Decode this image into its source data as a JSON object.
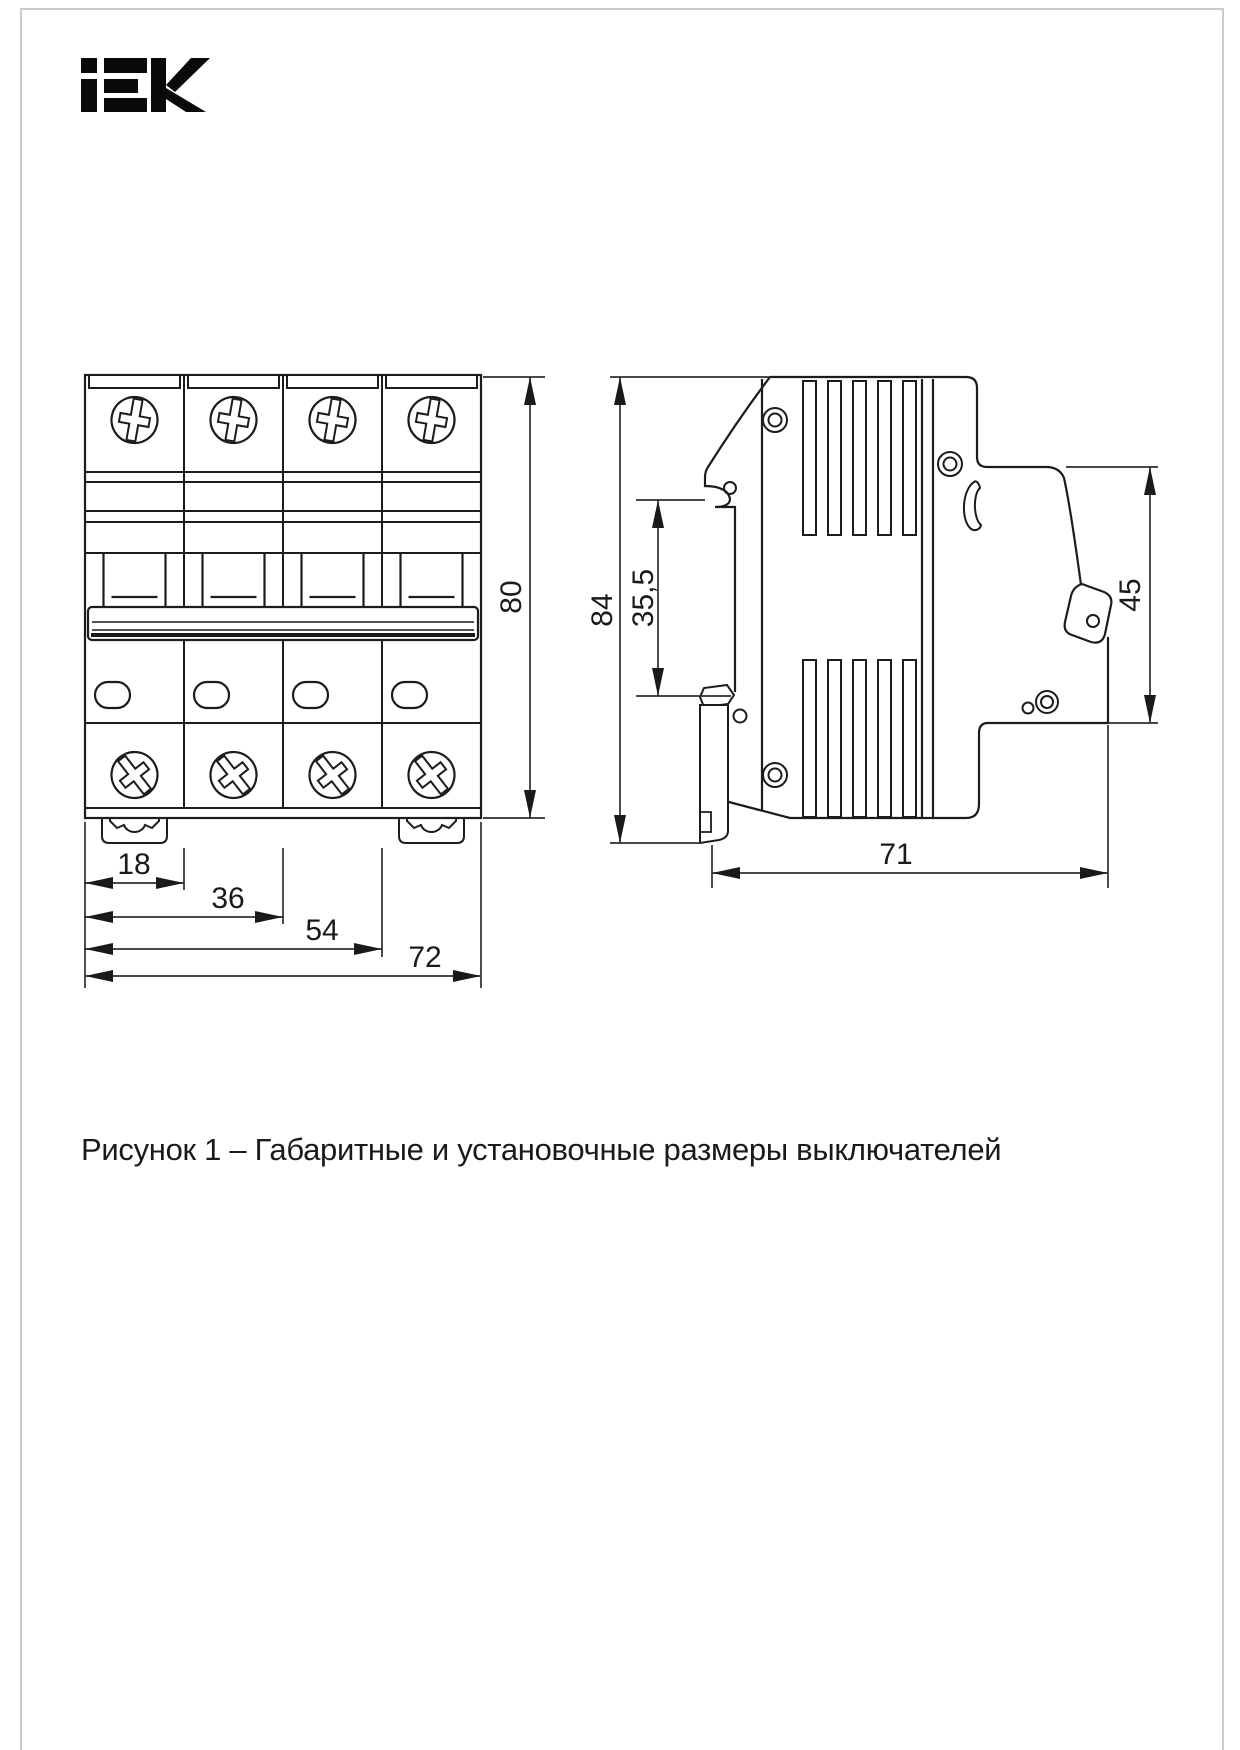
{
  "brand": {
    "name": "IEK"
  },
  "figure": {
    "caption": "Рисунок 1 – Габаритные и установочные размеры выключателей",
    "front_view": {
      "dims": {
        "w1": "18",
        "w2": "36",
        "w3": "54",
        "w4": "72",
        "h": "80"
      }
    },
    "side_view": {
      "dims": {
        "h": "84",
        "rail": "35,5",
        "terminal": "45",
        "depth": "71"
      }
    }
  }
}
